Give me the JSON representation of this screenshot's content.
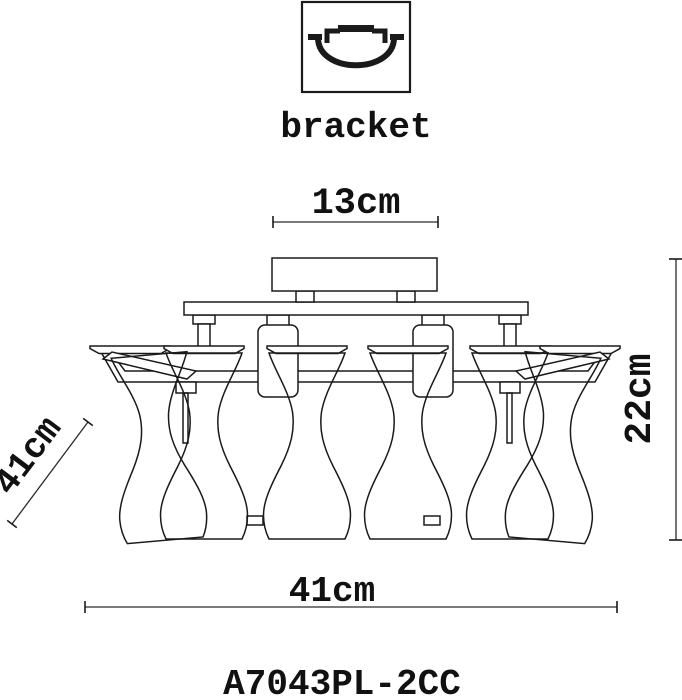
{
  "colors": {
    "ink": "#1a1a1a",
    "background": "#ffffff"
  },
  "bracket_section": {
    "icon": "bracket-mount-icon",
    "label": "bracket"
  },
  "dimensions": {
    "canopy_width": "13cm",
    "fixture_height": "22cm",
    "fixture_depth": "41cm",
    "fixture_width": "41cm"
  },
  "model_number": "A7043PL-2CC"
}
